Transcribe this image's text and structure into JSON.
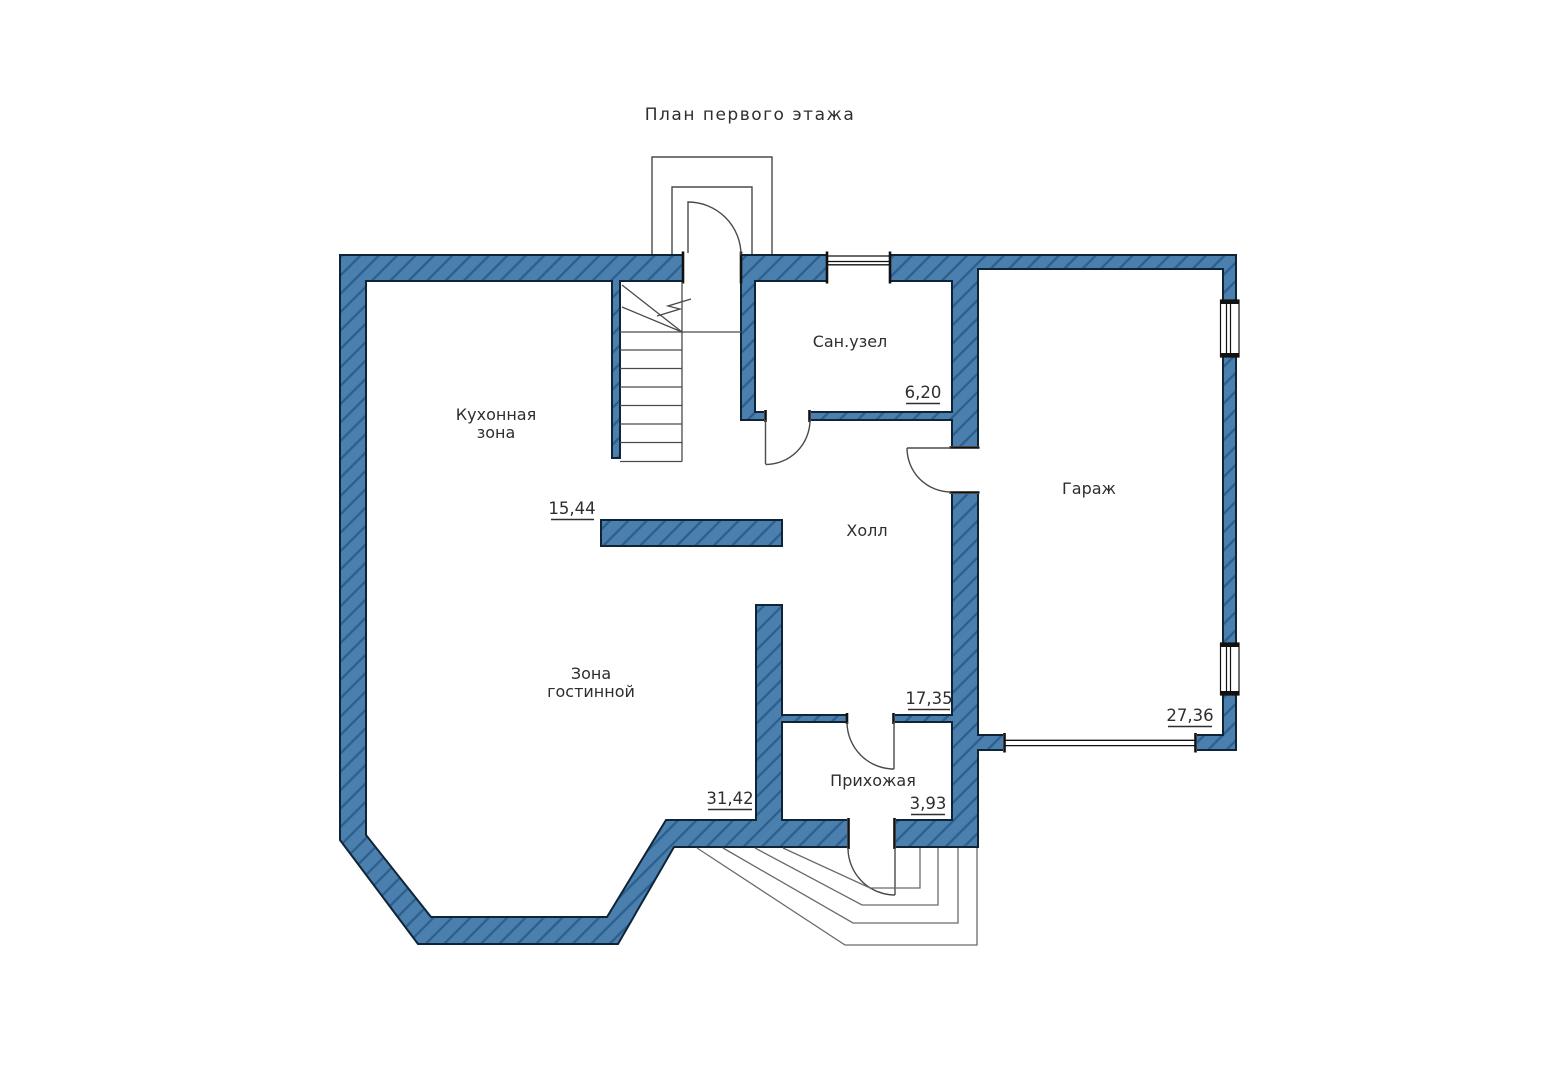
{
  "title": "План первого этажа",
  "rooms": {
    "kitchen": {
      "name_line1": "Кухонная",
      "name_line2": "зона",
      "area": "15,44"
    },
    "living": {
      "name_line1": "Зона",
      "name_line2": "гостинной",
      "area": "31,42"
    },
    "hall": {
      "name": "Холл",
      "area": "17,35"
    },
    "bathroom": {
      "name": "Сан.узел",
      "area": "6,20"
    },
    "garage": {
      "name": "Гараж",
      "area": "27,36"
    },
    "entry": {
      "name": "Прихожая",
      "area": "3,93"
    }
  },
  "colors": {
    "wall_fill": "#4a7fae",
    "hatch_line": "#2c5f8e",
    "outline": "#0f2537",
    "thin_line": "#4a4a4a",
    "step_line": "#6a6a6a",
    "window_line": "#111111",
    "text": "#2e2e2e"
  }
}
